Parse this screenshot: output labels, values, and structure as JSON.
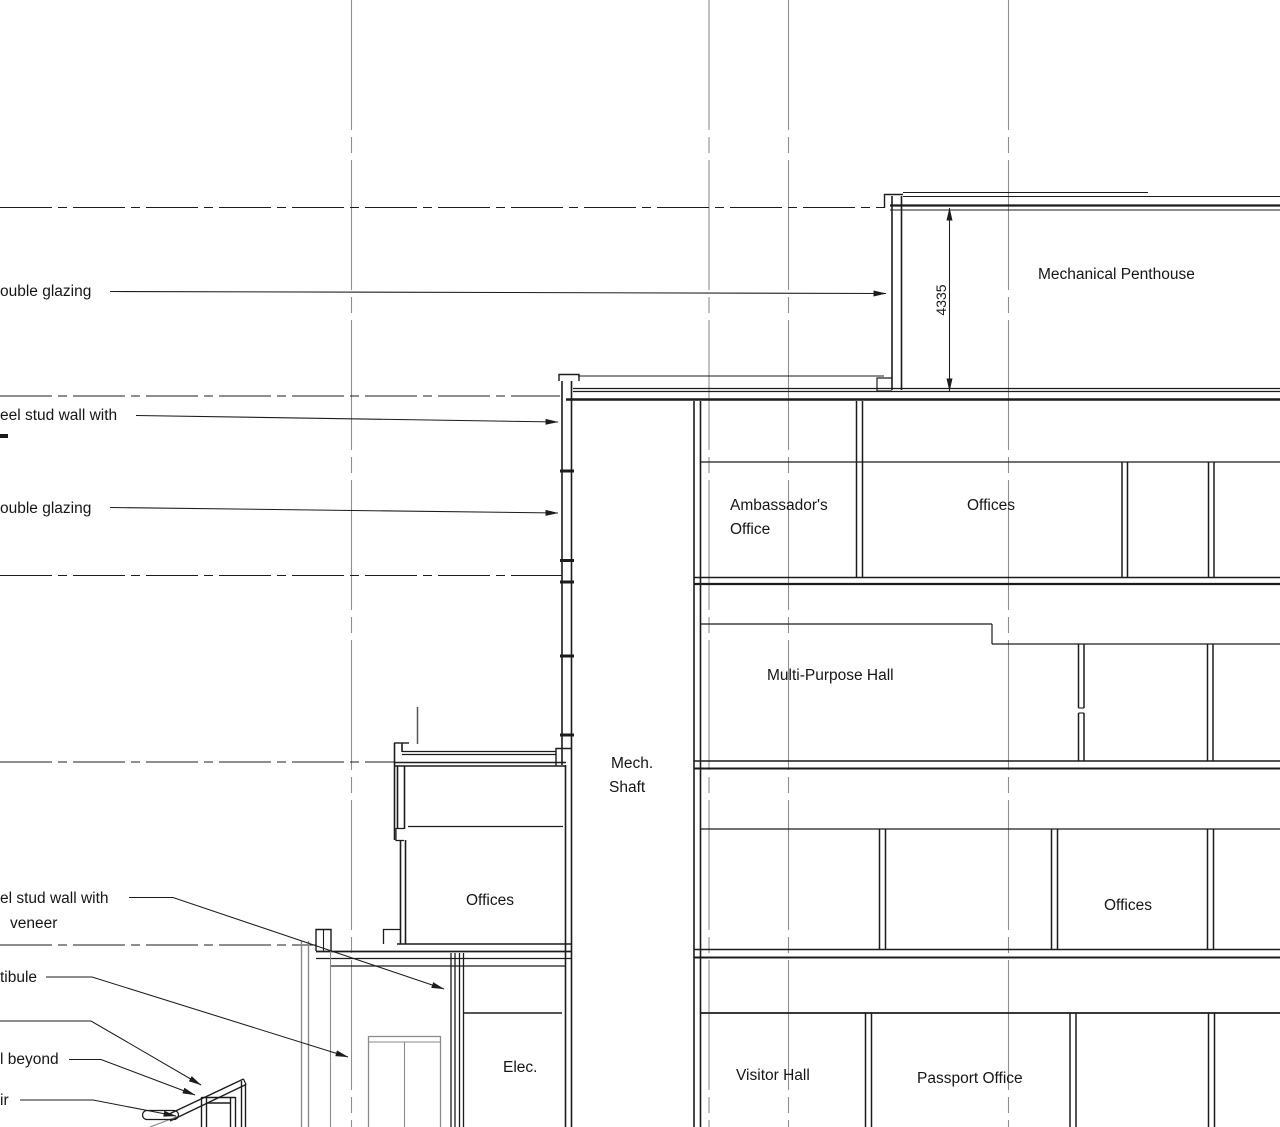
{
  "drawing": {
    "kind": "building-section",
    "colors": {
      "background": "#ffffff",
      "line": "#1c1c1c",
      "grid": "#8f8f8f",
      "beyond": "#8a8a8a"
    }
  },
  "rooms": {
    "mechanical_penthouse": "Mechanical Penthouse",
    "ambassadors_office_line1": "Ambassador's",
    "ambassadors_office_line2": "Office",
    "offices_level4": "Offices",
    "multi_purpose_hall": "Multi-Purpose Hall",
    "mech_shaft_line1": "Mech.",
    "mech_shaft_line2": "Shaft",
    "offices_level2_left": "Offices",
    "offices_level2_right": "Offices",
    "elec": "Elec.",
    "visitor_hall": "Visitor Hall",
    "passport_office": "Passport Office"
  },
  "dimensions": {
    "penthouse_height": "4335"
  },
  "annotations": {
    "double_glazing_upper": "ouble glazing",
    "steel_stud_upper": "eel stud wall with",
    "double_glazing_lower": "ouble glazing",
    "steel_stud_lower_line1": "el stud wall with",
    "steel_stud_lower_line2": "veneer",
    "vestibule": "tibule",
    "wall_beyond": "l beyond",
    "stair": "ir"
  }
}
